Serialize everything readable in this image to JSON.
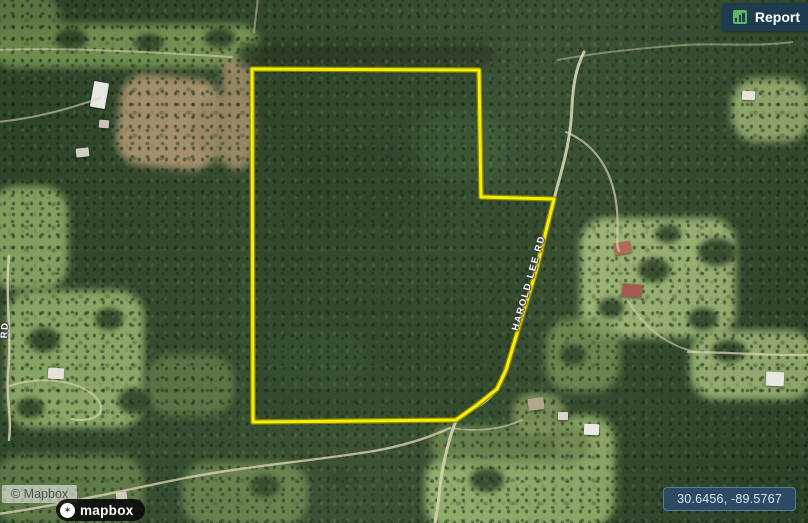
{
  "ui": {
    "report_button": {
      "label": "Report",
      "icon": "bar-chart",
      "bg_color": "#1d3c50",
      "icon_color": "#5cb85c",
      "text_color": "#ffffff"
    },
    "coordinates_readout": {
      "value": "30.6456, -89.5767",
      "bg_color": "#2c4a63",
      "border_color": "#567a93",
      "text_color": "#d9e7f3"
    },
    "attribution": {
      "text": "© Mapbox"
    },
    "mapbox_logo": {
      "text": "mapbox",
      "icon": "mapbox-circle-mark"
    }
  },
  "map": {
    "view": "satellite",
    "boundary_color": "#f7ee00",
    "road_labels": [
      {
        "id": "harold-lee-rd",
        "text": "HAROLD LEE RD"
      },
      {
        "id": "left-edge-road",
        "text": "RD"
      }
    ]
  }
}
